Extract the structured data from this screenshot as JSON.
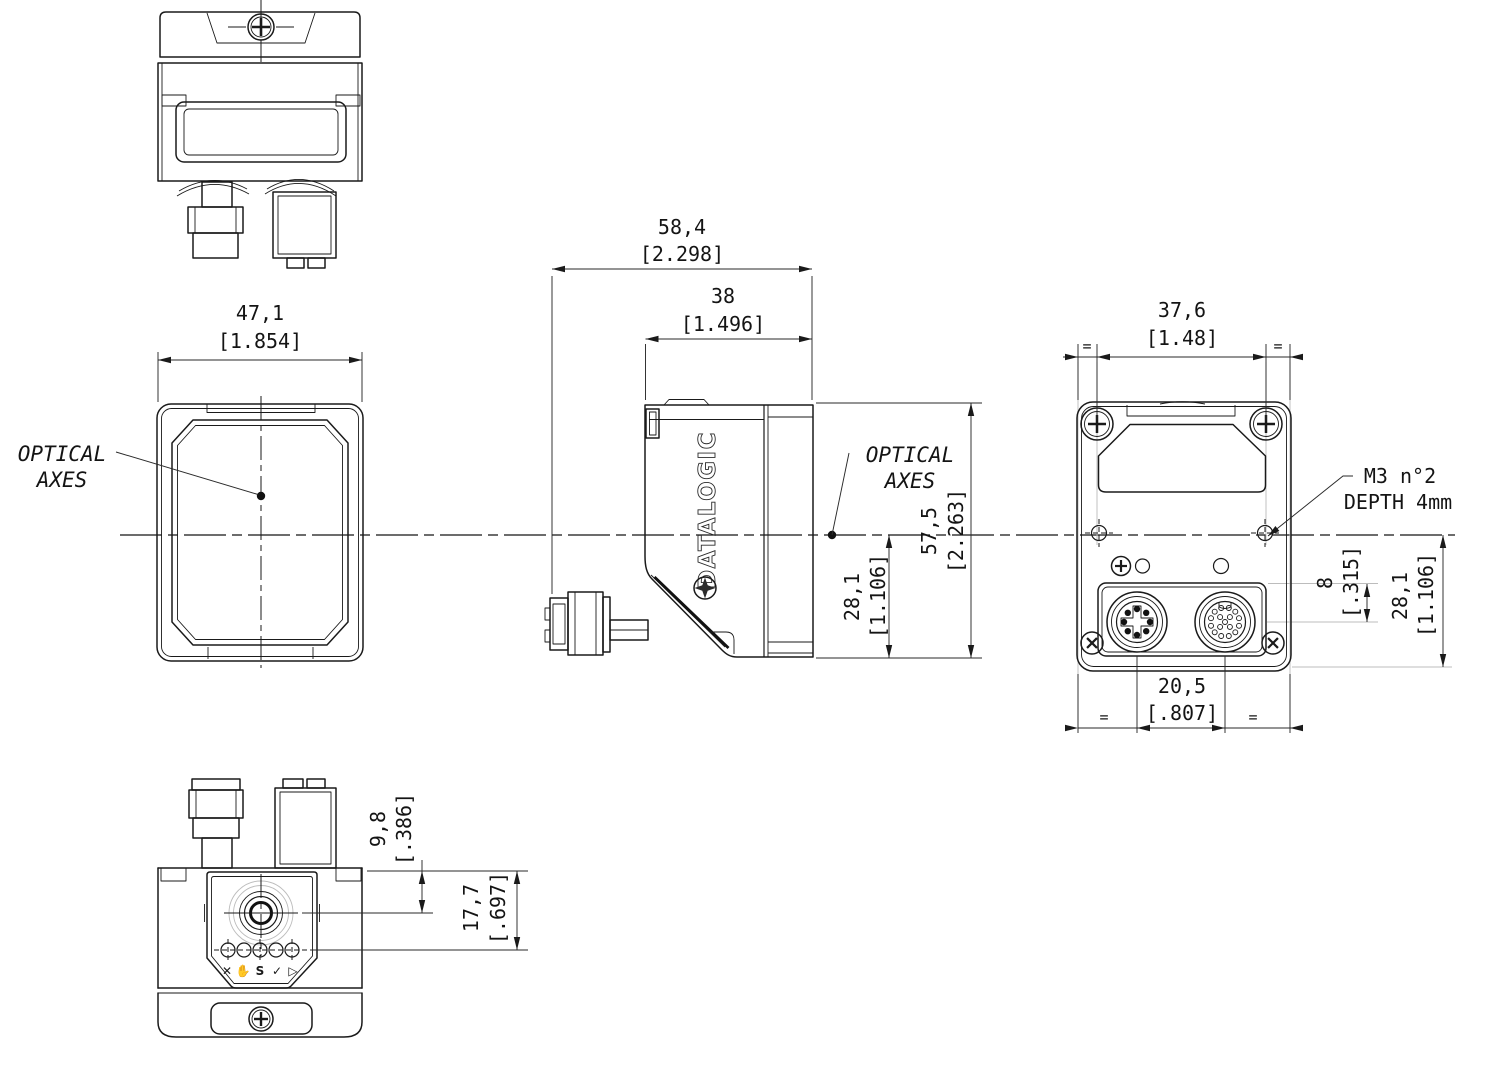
{
  "drawing": {
    "brand_logo": "DATALOGIC",
    "axis_label": {
      "line1": "OPTICAL",
      "line2": "AXES"
    },
    "m3_note": {
      "line1": "M3 n°2",
      "line2": "DEPTH 4mm"
    },
    "equal_mark": "=",
    "dims": {
      "front_width": {
        "mm": "47,1",
        "inch": "[1.854]"
      },
      "overall_depth": {
        "mm": "58,4",
        "inch": "[2.298]"
      },
      "body_depth": {
        "mm": "38",
        "inch": "[1.496]"
      },
      "overall_height": {
        "mm": "57,5",
        "inch": "[2.263]"
      },
      "axis_to_bottom_side": {
        "mm": "28,1",
        "inch": "[1.106]"
      },
      "screw_spacing": {
        "mm": "37,6",
        "inch": "[1.48]"
      },
      "connector_spacing": {
        "mm": "20,5",
        "inch": "[.807]"
      },
      "step_to_connector": {
        "mm": "8",
        "inch": "[.315]"
      },
      "axis_to_bottom_rear": {
        "mm": "28,1",
        "inch": "[1.106]"
      },
      "top_to_button": {
        "mm": "9,8",
        "inch": "[.386]"
      },
      "top_to_leds": {
        "mm": "17,7",
        "inch": "[.697]"
      }
    },
    "indicator_icons": [
      "✕",
      "✋",
      "S",
      "✓",
      "▷"
    ]
  }
}
